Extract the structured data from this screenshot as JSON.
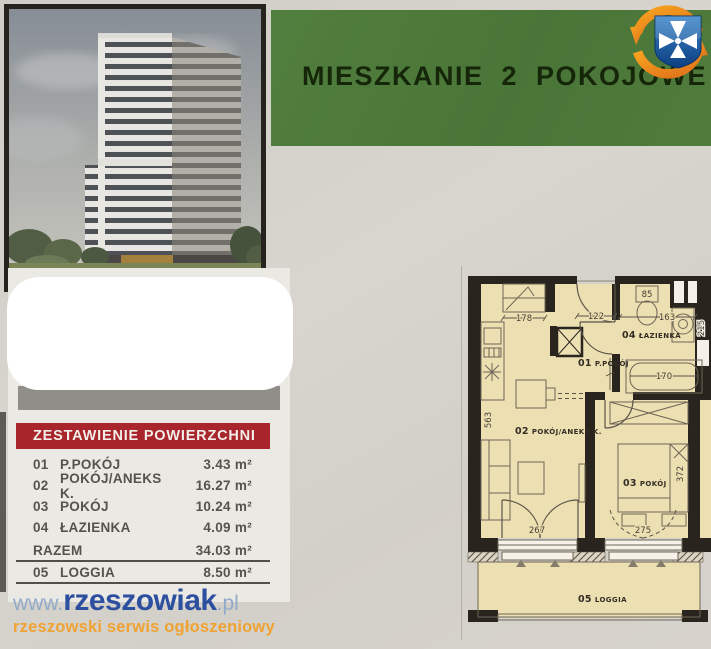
{
  "banner": {
    "title": "MIESZKANIE 2 POKOJOWE"
  },
  "area_table": {
    "header": "ZESTAWIENIE POWIERZCHNI",
    "rows": [
      {
        "no": "01",
        "name": "P.POKÓJ",
        "area": "3.43 m²"
      },
      {
        "no": "02",
        "name": "POKÓJ/ANEKS K.",
        "area": "16.27 m²"
      },
      {
        "no": "03",
        "name": "POKÓJ",
        "area": "10.24 m²"
      },
      {
        "no": "04",
        "name": "ŁAZIENKA",
        "area": "4.09 m²"
      }
    ],
    "total": {
      "label": "RAZEM",
      "area": "34.03 m²"
    },
    "extra": {
      "no": "05",
      "name": "LOGGIA",
      "area": "8.50 m²"
    }
  },
  "footer": {
    "url_prefix": "www.",
    "url_main": "rzeszowiak",
    "url_suffix": ".pl",
    "tagline": "rzeszowski serwis ogłoszeniowy"
  },
  "floor_plan": {
    "rooms": [
      {
        "no": "01",
        "name": "P.POKÓJ"
      },
      {
        "no": "02",
        "name": "POKÓJ/ANEKS K."
      },
      {
        "no": "03",
        "name": "POKÓJ"
      },
      {
        "no": "04",
        "name": "ŁAZIENKA"
      },
      {
        "no": "05",
        "name": "LOGGIA"
      }
    ],
    "dims": {
      "wardrobe": "178",
      "entrance": "122",
      "toilet": "85",
      "bath_width": "163",
      "bath_depth": "215",
      "tub": "170",
      "room2_height": "563",
      "window2": "267",
      "window3": "275",
      "room3_height": "372"
    }
  },
  "colors": {
    "banner_green": "#4a7538",
    "table_header_red": "#a8252b",
    "plan_cream": "#ecdfb2",
    "plan_wall": "#29241e",
    "logo_blue": "#2d4f9f",
    "logo_light_blue": "#92aac9",
    "tagline_orange": "#f0a232",
    "badge_orange": "#ef8d20",
    "badge_shield_blue": "#1d5aa8"
  }
}
